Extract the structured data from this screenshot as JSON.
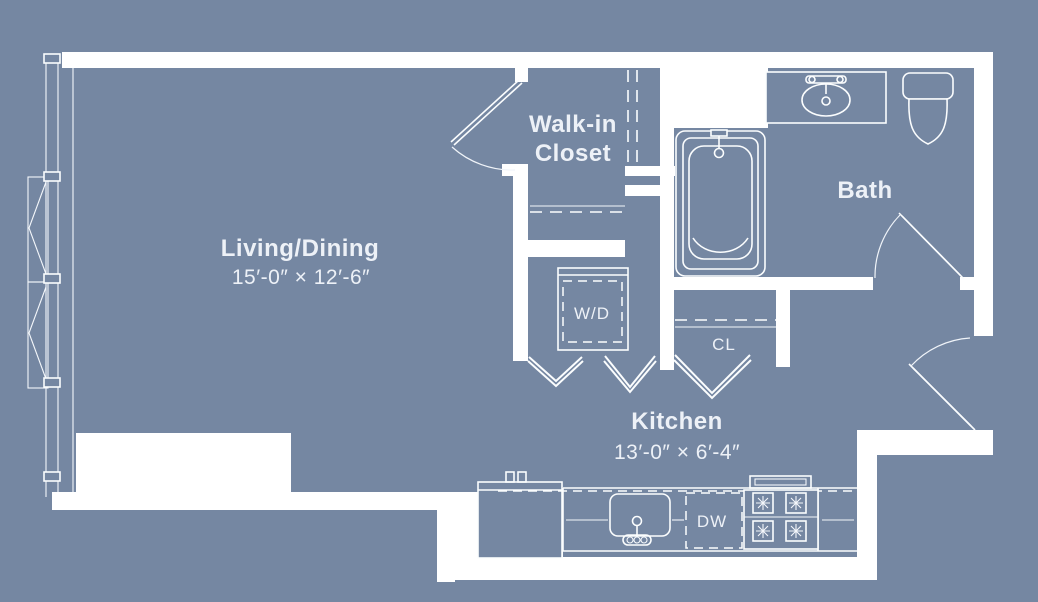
{
  "title": "Studio apartment floor plan",
  "colors": {
    "background": "#7587a2",
    "wall_fill": "#ffffff",
    "line": "#fbfdfe",
    "text": "#edf1f7"
  },
  "rooms": {
    "living": {
      "name": "Living/Dining",
      "dims": "15′-0″ × 12′-6″"
    },
    "walk_in_closet": {
      "line1": "Walk-in",
      "line2": "Closet"
    },
    "bath": {
      "name": "Bath"
    },
    "kitchen": {
      "name": "Kitchen",
      "dims": "13′-0″ × 6′-4″"
    },
    "laundry": {
      "name": "W/D"
    },
    "hall_closet": {
      "name": "CL"
    },
    "dishwasher": {
      "name": "DW"
    }
  }
}
